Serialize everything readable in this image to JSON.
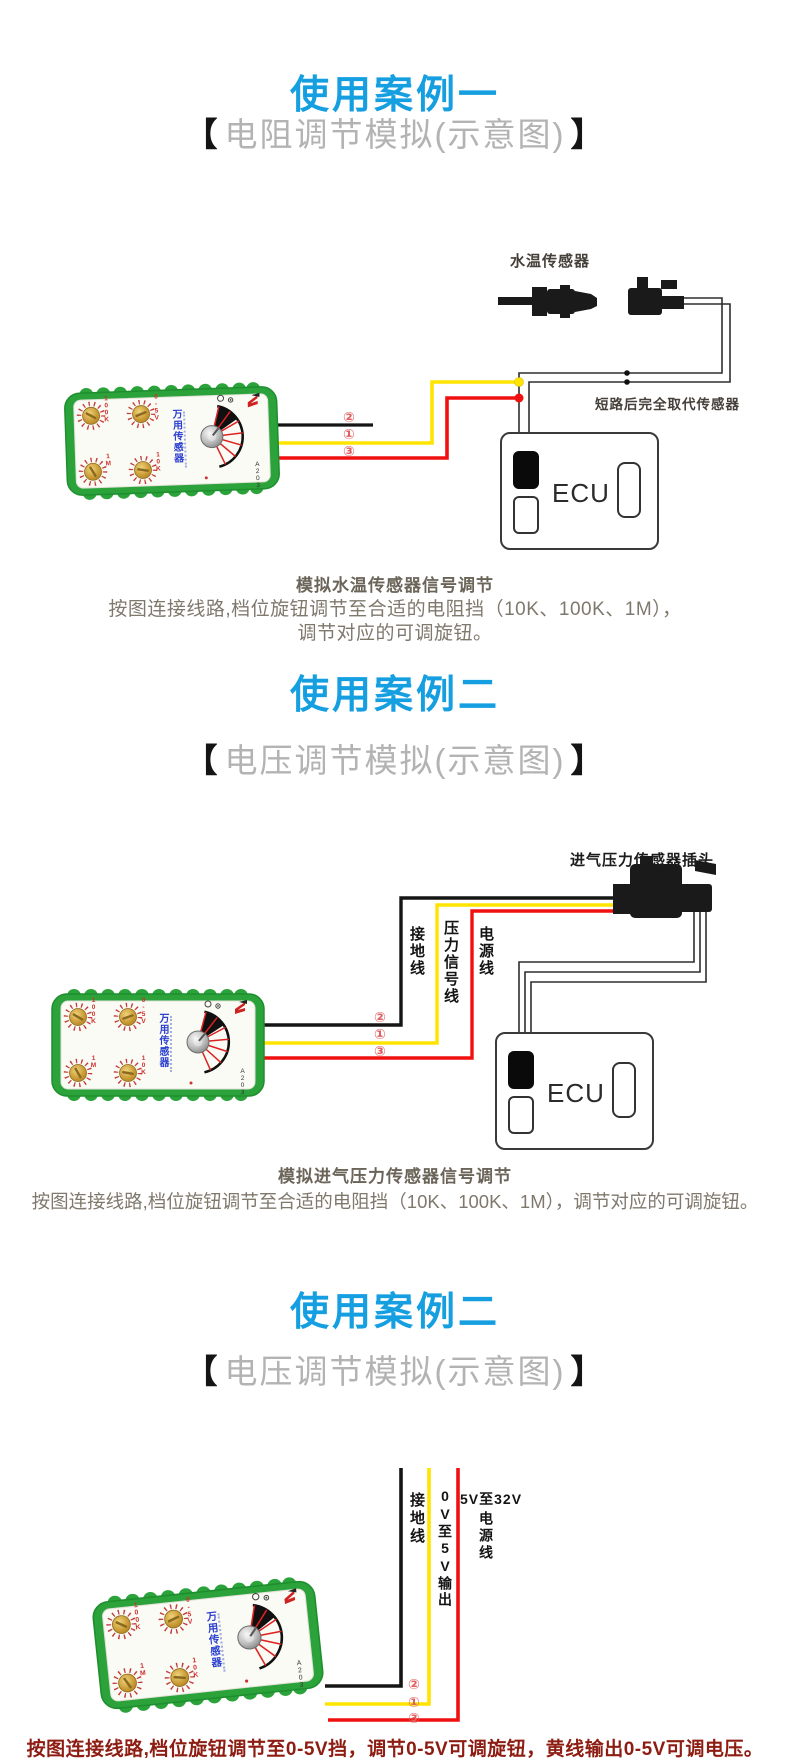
{
  "colors": {
    "accent_blue": "#169fe0",
    "wire_black": "#151515",
    "wire_yellow": "#ffe400",
    "wire_red": "#f01010",
    "device_green": "#2ba33a",
    "body_text": "#7f786d",
    "warning_red": "#8d1d12"
  },
  "device": {
    "name": "万用传感器",
    "model": "A203",
    "knobs": [
      "100K",
      "0-5V",
      "1M",
      "10K"
    ]
  },
  "sections": [
    {
      "title": "使用案例一",
      "subtitle_open": "【",
      "subtitle_text": "电阻调节模拟(示意图)",
      "subtitle_close": "】",
      "labels": {
        "sensor": "水温传感器",
        "short_note": "短路后完全取代传感器",
        "ecu": "ECU",
        "wire2": "②",
        "wire1": "①",
        "wire3": "③"
      },
      "heading": "模拟水温传感器信号调节",
      "body_line1": "按图连接线路,档位旋钮调节至合适的电阻挡（10K、100K、1M），",
      "body_line2": "调节对应的可调旋钮。"
    },
    {
      "title": "使用案例二",
      "subtitle_open": "【",
      "subtitle_text": "电压调节模拟(示意图)",
      "subtitle_close": "】",
      "labels": {
        "plug": "进气压力传感器插头",
        "ground": "接地线",
        "signal": "压力信号线",
        "power": "电源线",
        "ecu": "ECU",
        "wire2": "②",
        "wire1": "①",
        "wire3": "③"
      },
      "heading": "模拟进气压力传感器信号调节",
      "body_line1": "按图连接线路,档位旋钮调节至合适的电阻挡（10K、100K、1M），调节对应的可调旋钮。"
    },
    {
      "title": "使用案例二",
      "subtitle_open": "【",
      "subtitle_text": "电压调节模拟(示意图)",
      "subtitle_close": "】",
      "labels": {
        "ground": "接地线",
        "output": "0V至5V输出",
        "power_top": "5V至32V",
        "power": "电源线",
        "wire2": "②",
        "wire1": "①",
        "wire3": "③"
      },
      "body_red": "按图连接线路,档位旋钮调节至0-5V挡，调节0-5V可调旋钮，黄线输出0-5V可调电压。"
    }
  ]
}
